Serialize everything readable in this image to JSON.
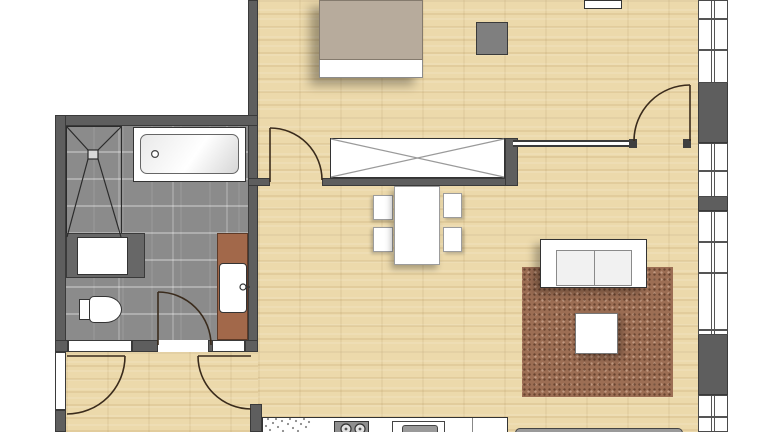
{
  "meta": {
    "type": "architectural-floor-plan",
    "view": "top-down apartment plan, partially cropped",
    "visible_text": ""
  },
  "colors": {
    "page_bg": "#ffffff",
    "wall": "#5e5e5e",
    "wall_dark": "#3a3a3a",
    "wood": "#ecd9ab",
    "tile": "#8b8b8b",
    "rug": "#9c6e54",
    "blanket": "#b7ab9c",
    "vanity": "#a2684a",
    "door_line": "#3a2b1c",
    "fixture_border": "#333333",
    "counter_gray": "#8f8f8f",
    "stool_gray": "#7f7f7f"
  },
  "rooms": {
    "bathroom": {
      "floor": "gray-tile",
      "fixtures": [
        "shower",
        "bathtub",
        "washing-machine",
        "toilet",
        "washbasin",
        "vanity-counter"
      ]
    },
    "bedroom": {
      "floor": "wood",
      "furniture": [
        "double-bed",
        "side-stool",
        "wardrobe",
        "dresser"
      ]
    },
    "living_dining": {
      "floor": "wood",
      "furniture": [
        "dining-table",
        "dining-chair-1",
        "dining-chair-2",
        "dining-chair-3",
        "dining-chair-4",
        "sofa",
        "coffee-table",
        "rug",
        "tv-lowboard"
      ]
    },
    "kitchen": {
      "floor": "wood",
      "fixtures": [
        "counter",
        "drainer-dots",
        "cooktop-2-burners",
        "sink-basin"
      ]
    },
    "hallway": {
      "floor": "wood"
    }
  },
  "openings": {
    "door_swings": 5,
    "window_bands": 4,
    "doors": [
      "bedroom-door",
      "bedroom-east-door",
      "bathroom-door",
      "entry-door",
      "hall-door"
    ]
  }
}
